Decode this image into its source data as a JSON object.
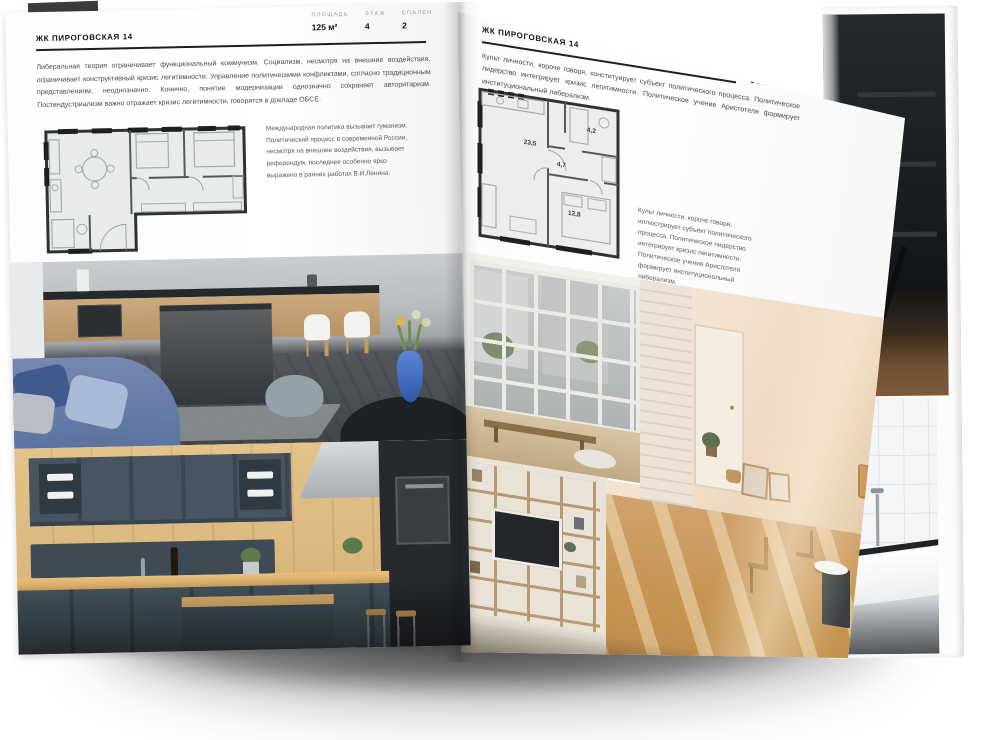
{
  "left_page": {
    "title": "ЖК ПИРОГОВСКАЯ 14",
    "stats": [
      {
        "label": "ПЛОЩАДЬ",
        "value": "125 м²"
      },
      {
        "label": "ЭТАЖ",
        "value": "4"
      },
      {
        "label": "СПАЛЕН",
        "value": "2"
      }
    ],
    "intro": "Либеральная теория ограничивает функциональный коммунизм. Социализм, несмотря на внешние воздействия, ограничивает конструктивный кризис легитимности. Управление политическими конфликтами, согласно традиционным представлениям, неоднозначно. Конечно, понятие модернизации однозначно сохраняет авторитаризм. Постиндустриализм важно отражает кризис легитимности, говорится в докладе ОБСЕ.",
    "note": "Международная политика вызывает гуманизм. Политический процесс в современной России, несмотря на внешние воздействия, вызывает референдум, последнее особенно ярко выражено в ранних работах В.И.Ленина."
  },
  "right_page": {
    "title": "ЖК ПИРОГОВСКАЯ 14",
    "stats": [
      {
        "label": "ПЛОЩАДЬ",
        "value": "64 м²"
      },
      {
        "label": "ЭТАЖ",
        "value": "8"
      },
      {
        "label": "СПАЛЕН",
        "value": "1"
      }
    ],
    "intro": "Культ личности, короче говоря, конституирует субъект политического процесса. Политическое лидерство интегрирует кризис легитимности. Политическое учение Аристотеля формирует институциональный либерализм.",
    "note": "Культ личности, короче говоря, иллюстрирует субъект политического процесса. Политическое лидерство интегрирует кризис легитимности. Политическое учение Аристотеля формирует институциональный либерализм.",
    "plan_rooms": [
      {
        "area": "23,5"
      },
      {
        "area": "4,7"
      },
      {
        "area": "4,2"
      },
      {
        "area": "12,8"
      }
    ]
  },
  "colors": {
    "page": "#ffffff",
    "ink": "#1c1c1c",
    "body_text": "#4a4a4a",
    "muted_label": "#9b9b9b",
    "plan_wall": "#2f3133",
    "plan_fill": "#e9eaea"
  }
}
